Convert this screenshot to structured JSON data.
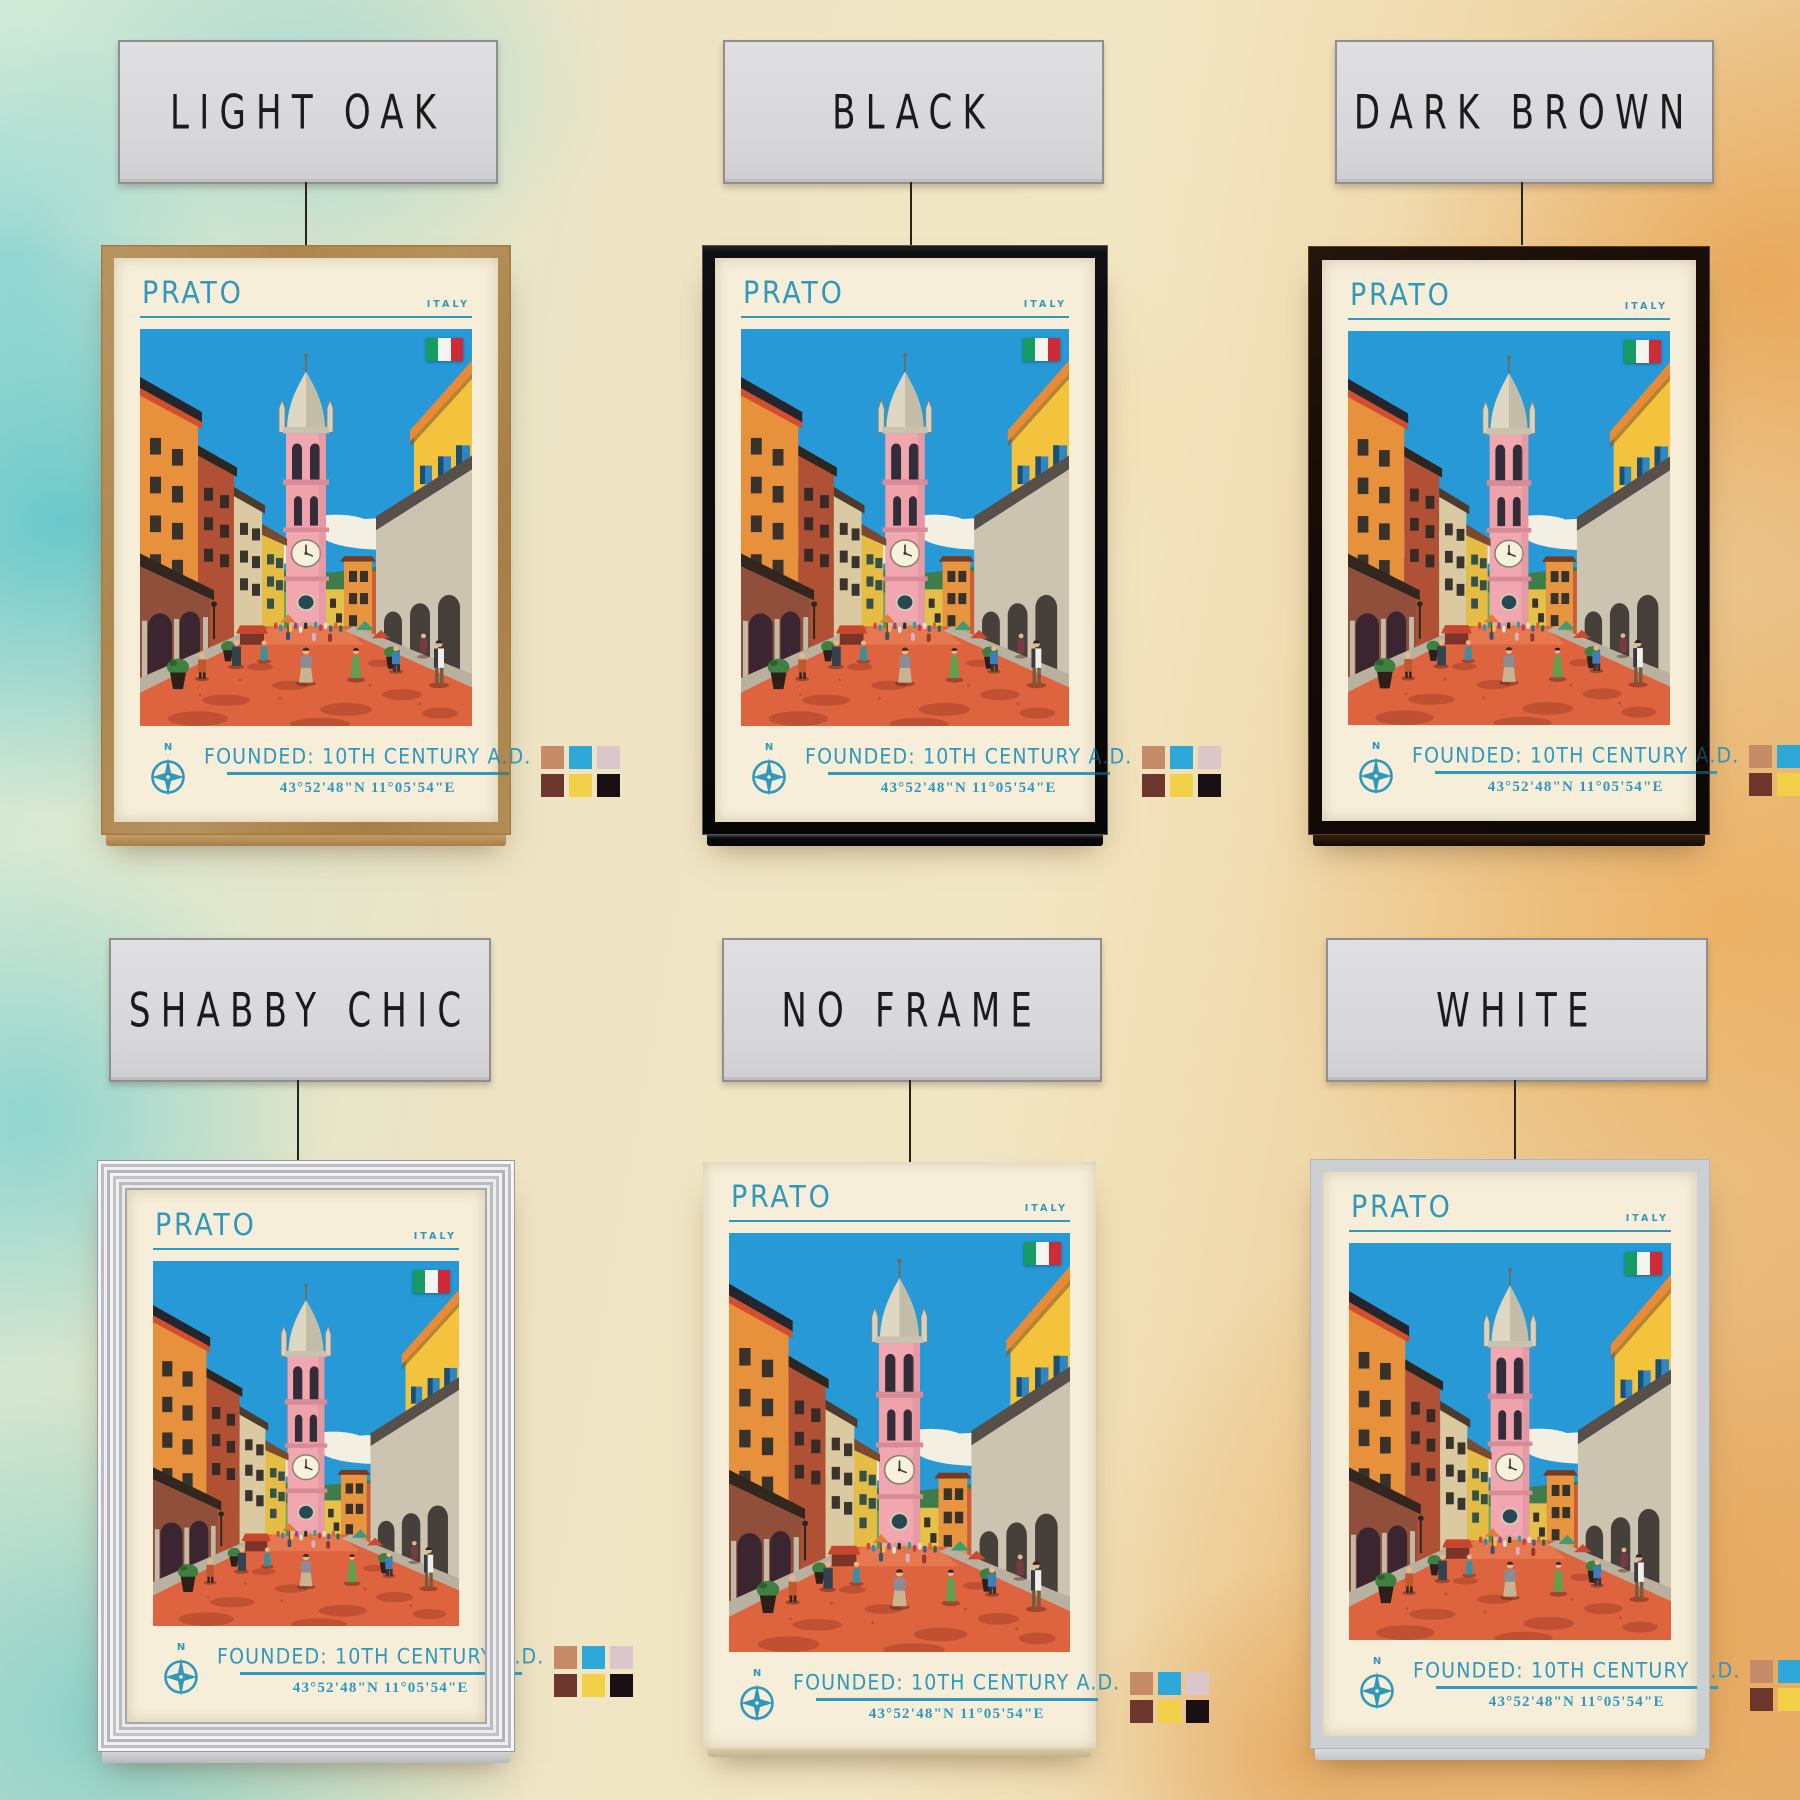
{
  "wall": {
    "left_wash_color": "#5ec4ca",
    "right_wash_color": "#e79a3a",
    "base_color": "#efe3c2"
  },
  "label_cards": {
    "background": "#d9d9db",
    "text_color": "#1b1b1b"
  },
  "poster": {
    "title": "PRATO",
    "country": "ITALY",
    "founded": "FOUNDED: 10TH CENTURY A.D.",
    "coordinates": "43°52'48\"N 11°05'54\"E",
    "compass_label": "N",
    "accent": "#2f98bc",
    "flag_colors": [
      "#169b62",
      "#f4f4f0",
      "#ce2b37"
    ],
    "swatches": [
      "#c68b69",
      "#2ea7d9",
      "#dbc7cb",
      "#6d372e",
      "#f2d149",
      "#191014"
    ]
  },
  "variants": [
    {
      "id": "light-oak",
      "label": "LIGHT OAK",
      "frame_color": "#d8ae74"
    },
    {
      "id": "black",
      "label": "BLACK",
      "frame_color": "#1c1c1f"
    },
    {
      "id": "dark-brown",
      "label": "DARK BROWN",
      "frame_color": "#2e1b10"
    },
    {
      "id": "shabby-chic",
      "label": "SHABBY CHIC",
      "frame_color": "#e4e4e6"
    },
    {
      "id": "no-frame",
      "label": "NO FRAME",
      "frame_color": "none"
    },
    {
      "id": "white",
      "label": "WHITE",
      "frame_color": "#eef0f2"
    }
  ]
}
